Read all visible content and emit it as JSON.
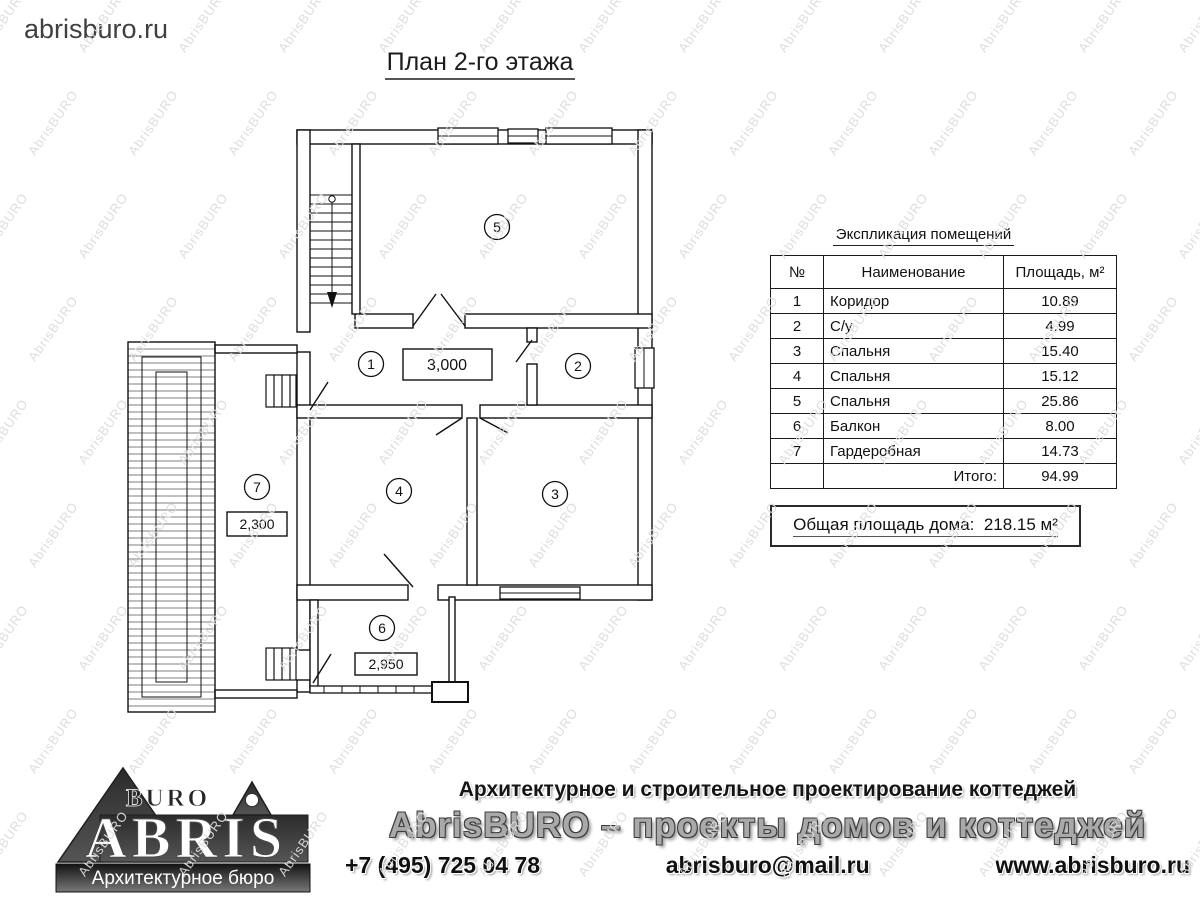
{
  "header": {
    "site": "abrisburo.ru",
    "title": "План 2-го этажа"
  },
  "watermark": {
    "text": "AbrisBURO"
  },
  "plan": {
    "room_numbers": [
      "1",
      "2",
      "3",
      "4",
      "5",
      "6",
      "7"
    ],
    "dimensions": {
      "corridor": "3,000",
      "dressing": "2,300",
      "balcony": "2,950"
    }
  },
  "spec_table": {
    "title": "Экспликация помещений",
    "headers": [
      "№",
      "Наименование",
      "Площадь, м²"
    ],
    "rows": [
      {
        "n": "1",
        "name": "Коридор",
        "area": "10.89"
      },
      {
        "n": "2",
        "name": "С/у",
        "area": "4.99"
      },
      {
        "n": "3",
        "name": "Спальня",
        "area": "15.40"
      },
      {
        "n": "4",
        "name": "Спальня",
        "area": "15.12"
      },
      {
        "n": "5",
        "name": "Спальня",
        "area": "25.86"
      },
      {
        "n": "6",
        "name": "Балкон",
        "area": "8.00"
      },
      {
        "n": "7",
        "name": "Гардеробная",
        "area": "14.73"
      }
    ],
    "total_label": "Итого:",
    "total_value": "94.99"
  },
  "summary": {
    "label": "Общая площадь дома:",
    "value": "218.15 м²"
  },
  "footer": {
    "logo": {
      "top": "BURO",
      "main": "ABRIS",
      "tagline": "Архитектурное бюро"
    },
    "line1": "Архитектурное и строительное проектирование коттеджей",
    "line2": "AbrisBURO – проекты домов и коттеджей",
    "phone": "+7 (495) 725 04 78",
    "email": "abrisburo@mail.ru",
    "website": "www.abrisburo.ru"
  }
}
